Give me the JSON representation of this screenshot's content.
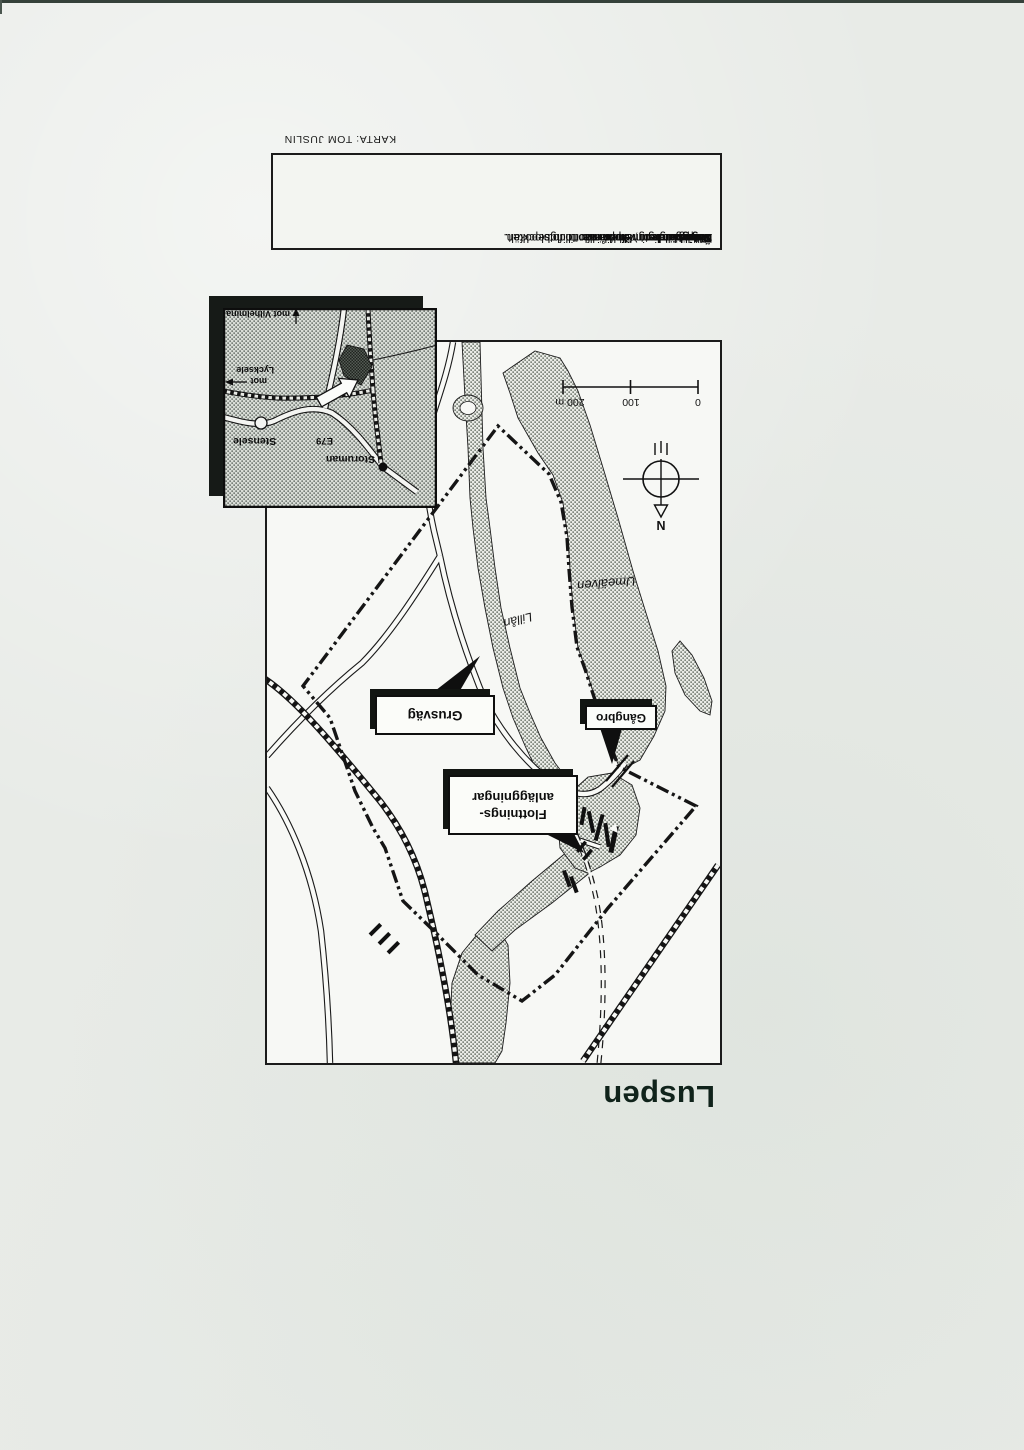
{
  "page": {
    "credit": "KARTA: TOM JUSLIN"
  },
  "title": "Luspen",
  "info": {
    "rows": [
      {
        "label": "Namn:",
        "line1": "Luspen"
      },
      {
        "label": "Läge:",
        "line1": "1 km söder om Storuman",
        "line2": "vid vägen mot Vilhelmina."
      },
      {
        "label": "Yta:",
        "line1": "30 hektar"
      },
      {
        "label": "Naturvärde:",
        "line1": "Kalspolat berg, klipprännor och blockfält."
      },
      {
        "label": "Övrigt:",
        "line1": "Även kulturminnen från flottningsepoken.",
        "line2": "Lättillgängligt med bil eller till fots."
      }
    ]
  },
  "map": {
    "labels": {
      "river_main": "Umeälven",
      "river_small": "Lillån",
      "gravel_road": "Grusväg",
      "footbridge": "Gångbro",
      "flottning_line1": "Flottnings-",
      "flottning_line2": "anläggningar",
      "north": "N"
    },
    "scale": {
      "t0": "0",
      "t100": "100",
      "t200": "200 m"
    }
  },
  "inset": {
    "labels": {
      "town": "Storuman",
      "road": "E79",
      "village": "Stensele",
      "dir_east_1": "mot",
      "dir_east_2": "Lycksele",
      "dir_north": "mot Vilhelmina"
    }
  },
  "colors": {
    "paper": "#e8ebe7",
    "ink": "#111111",
    "map_bg": "#f7f8f5",
    "stipple": "#7f867c",
    "inset_bg": "#d8dcd6",
    "title_ink": "#10231b"
  }
}
